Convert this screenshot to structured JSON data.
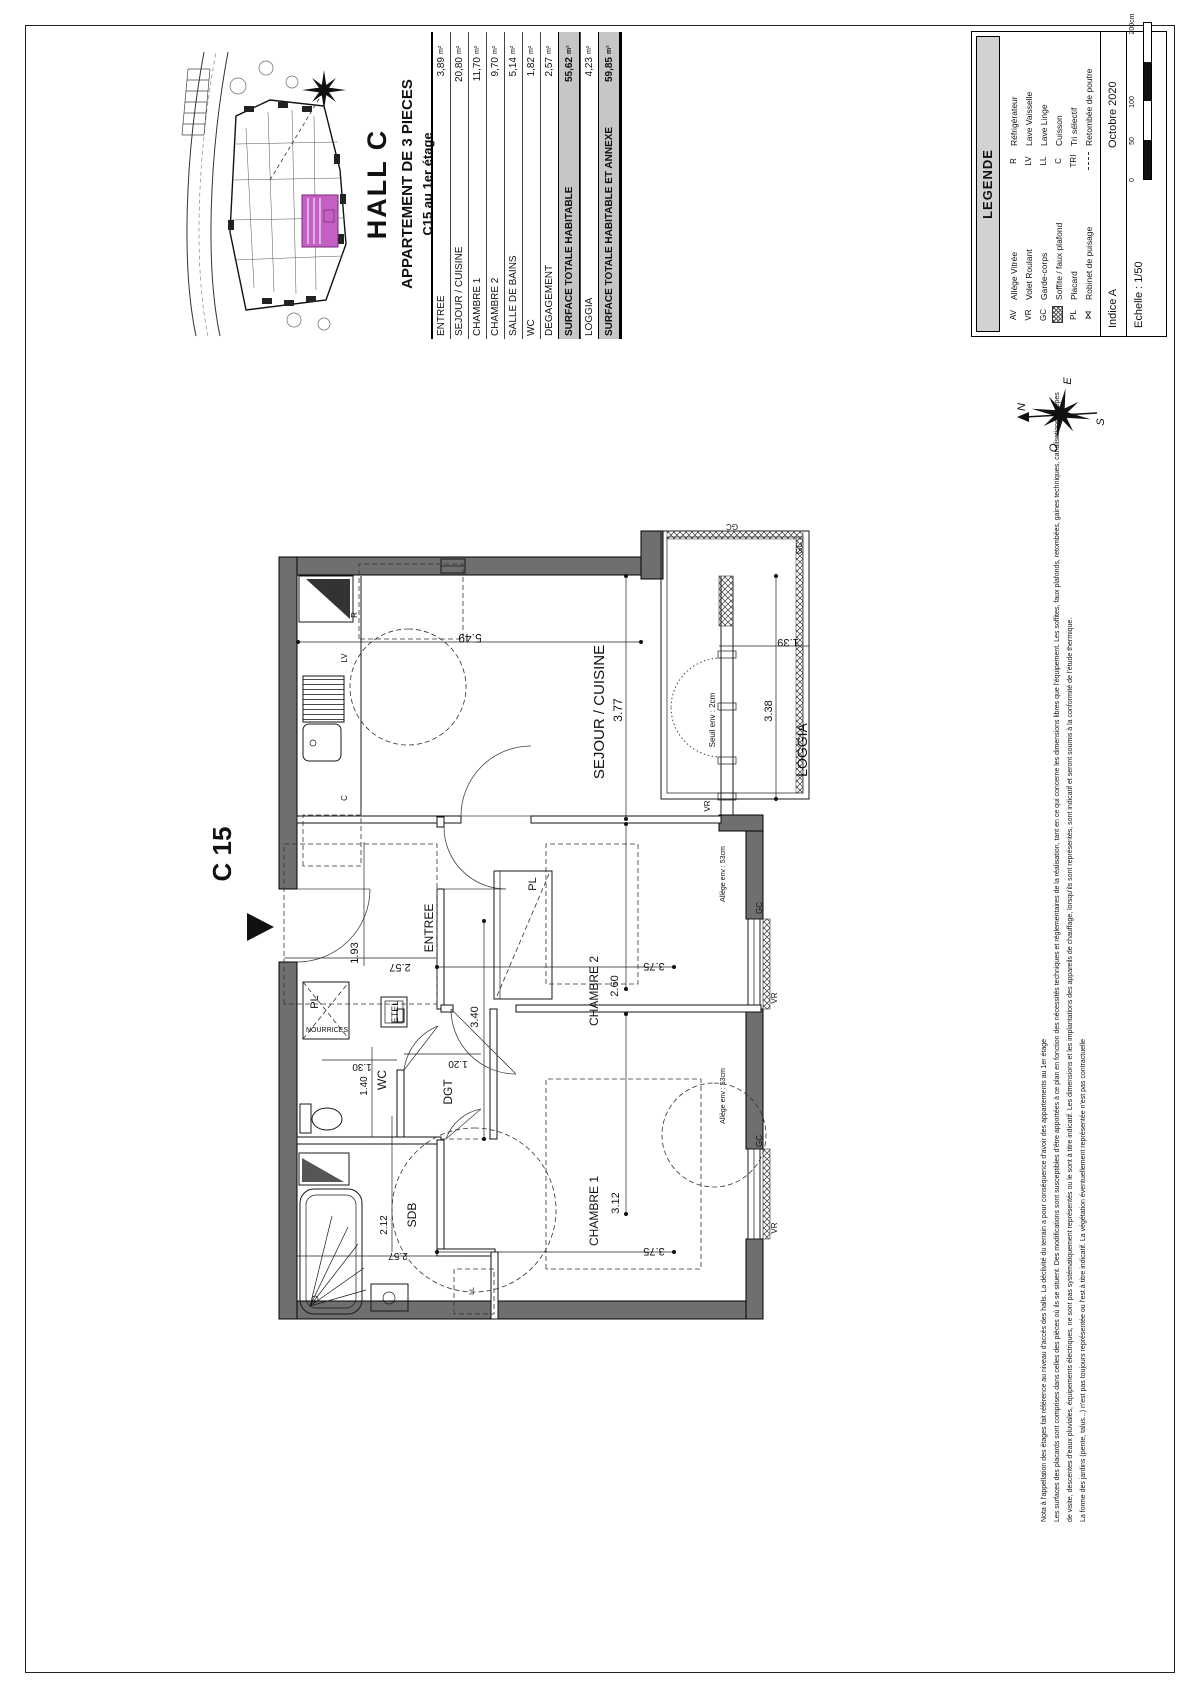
{
  "sheet": {
    "hall": "HALL C",
    "apartment_type": "APPARTEMENT DE 3 PIECES",
    "apartment_floor": "C15 au 1er étage",
    "unit_label": "C 15"
  },
  "areas_table": {
    "rows": [
      {
        "label": "ENTREE",
        "value": "3,89",
        "unit": "m²",
        "highlight": false
      },
      {
        "label": "SEJOUR / CUISINE",
        "value": "20,80",
        "unit": "m²",
        "highlight": false
      },
      {
        "label": "CHAMBRE 1",
        "value": "11,70",
        "unit": "m²",
        "highlight": false
      },
      {
        "label": "CHAMBRE 2",
        "value": "9,70",
        "unit": "m²",
        "highlight": false
      },
      {
        "label": "SALLE DE BAINS",
        "value": "5,14",
        "unit": "m²",
        "highlight": false
      },
      {
        "label": "WC",
        "value": "1,82",
        "unit": "m²",
        "highlight": false
      },
      {
        "label": "DEGAGEMENT",
        "value": "2,57",
        "unit": "m²",
        "highlight": false
      },
      {
        "label": "SURFACE TOTALE HABITABLE",
        "value": "55,62",
        "unit": "m²",
        "highlight": true
      },
      {
        "label": "LOGGIA",
        "value": "4,23",
        "unit": "m²",
        "highlight": false
      },
      {
        "label": "SURFACE TOTALE HABITABLE ET ANNEXE",
        "value": "59,85",
        "unit": "m²",
        "highlight": true
      }
    ]
  },
  "legend": {
    "title": "LEGENDE",
    "left": [
      {
        "abbr": "AV",
        "label": "Allège Vitrée",
        "icon": ""
      },
      {
        "abbr": "VR",
        "label": "Volet Roulant",
        "icon": ""
      },
      {
        "abbr": "GC",
        "label": "Garde-corps",
        "icon": ""
      },
      {
        "abbr": "",
        "label": "Soffite / faux plafond",
        "icon": "hatch"
      },
      {
        "abbr": "PL",
        "label": "Placard",
        "icon": ""
      },
      {
        "abbr": "",
        "label": "Robinet de puisage",
        "icon": "tap"
      }
    ],
    "right": [
      {
        "abbr": "R",
        "label": "Réfrigérateur",
        "icon": ""
      },
      {
        "abbr": "LV",
        "label": "Lave Vaisselle",
        "icon": ""
      },
      {
        "abbr": "LL",
        "label": "Lave Linge",
        "icon": ""
      },
      {
        "abbr": "C",
        "label": "Cuisson",
        "icon": ""
      },
      {
        "abbr": "TRI",
        "label": "Tri sélectif",
        "icon": ""
      },
      {
        "abbr": "",
        "label": "Retombée de poutre",
        "icon": "dash"
      }
    ]
  },
  "meta": {
    "indice": "Indice A",
    "date": "Octobre 2020",
    "scale": "Echelle :  1/50",
    "scale_ticks": [
      {
        "label": "0",
        "pos": 0
      },
      {
        "label": "50",
        "pos": 0.25
      },
      {
        "label": "100",
        "pos": 0.5
      },
      {
        "label": "200cm",
        "pos": 1
      }
    ]
  },
  "compass": {
    "n": "N",
    "e": "E",
    "s": "S",
    "o": "O"
  },
  "notes": {
    "lines": [
      "Nota à l'appellation des étages fait référence au niveau d'accès des halls. La déclivité du terrain a pour conséquence d'avoir des appartements au 1er étage",
      "Les surfaces des placards sont comprises dans celles des pièces où ils se situent. Des modifications sont susceptibles d'être apportées à ce plan en fonction des nécessités techniques et réglementaires de la réalisation, tant en ce qui concerne les dimensions libres que l'équipement. Les soffites, faux plafonds, retombées, gaines techniques, canalisations, trappes",
      "de visite, descentes d'eaux pluviales, équipements électriques, ne sont pas systématiquement représentés ou le sont à titre indicatif. Les dimensions et les implantations des appareils de chauffage, lorsqu'ils sont représentés, sont indicatif et seront soumis à la conformité de l'étude thermique.",
      "La forme des jardins (pente, talus...) n'est pas toujours représentée ou l'est à titre indicatif. La végétation éventuellement représentée n'est pas contractuelle"
    ]
  },
  "plan_labels": [
    {
      "t": "C 15",
      "x": 818,
      "y": 205,
      "s": 26,
      "b": true
    },
    {
      "t": "SEJOUR / CUISINE",
      "x": 960,
      "y": 578,
      "s": 15
    },
    {
      "t": "3.77",
      "x": 962,
      "y": 596,
      "s": 12
    },
    {
      "t": "5.49",
      "x": 1038,
      "y": 444,
      "s": 12,
      "r": -90
    },
    {
      "t": "LOGGIA",
      "x": 922,
      "y": 781,
      "s": 14
    },
    {
      "t": "3.38",
      "x": 961,
      "y": 746,
      "s": 11
    },
    {
      "t": "1.39",
      "x": 1033,
      "y": 762,
      "s": 11,
      "r": -90
    },
    {
      "t": "Seuil env : 2cm",
      "x": 952,
      "y": 689,
      "s": 8
    },
    {
      "t": "VR",
      "x": 866,
      "y": 684,
      "s": 8
    },
    {
      "t": "GC",
      "x": 1124,
      "y": 776,
      "s": 8
    },
    {
      "t": "GC",
      "x": 1148,
      "y": 706,
      "s": 8,
      "r": -90
    },
    {
      "t": "ENTREE",
      "x": 744,
      "y": 407,
      "s": 12
    },
    {
      "t": "1.93",
      "x": 719,
      "y": 332,
      "s": 11
    },
    {
      "t": "2.57",
      "x": 708,
      "y": 374,
      "s": 11,
      "r": -90
    },
    {
      "t": "3.40",
      "x": 655,
      "y": 452,
      "s": 11
    },
    {
      "t": "PL",
      "x": 670,
      "y": 292,
      "s": 11
    },
    {
      "t": "NOURRICES",
      "x": 640,
      "y": 280,
      "s": 7,
      "r": 90,
      "a": "start"
    },
    {
      "t": "ETEL",
      "x": 660,
      "y": 372,
      "s": 9
    },
    {
      "t": "WC",
      "x": 592,
      "y": 360,
      "s": 12
    },
    {
      "t": "1.30",
      "x": 608,
      "y": 336,
      "s": 10,
      "r": -90
    },
    {
      "t": "1.40",
      "x": 586,
      "y": 341,
      "s": 10
    },
    {
      "t": "DGT",
      "x": 580,
      "y": 426,
      "s": 12
    },
    {
      "t": "1.20",
      "x": 611,
      "y": 432,
      "s": 10,
      "r": -90
    },
    {
      "t": "SDB",
      "x": 457,
      "y": 390,
      "s": 12
    },
    {
      "t": "2.12",
      "x": 447,
      "y": 361,
      "s": 10
    },
    {
      "t": "2.57",
      "x": 419,
      "y": 372,
      "s": 10,
      "r": -90
    },
    {
      "t": "LL",
      "x": 381,
      "y": 448,
      "s": 7
    },
    {
      "t": "CHAMBRE 2",
      "x": 681,
      "y": 572,
      "s": 12
    },
    {
      "t": "2.60",
      "x": 686,
      "y": 592,
      "s": 11
    },
    {
      "t": "3.75",
      "x": 709,
      "y": 628,
      "s": 11,
      "r": -90
    },
    {
      "t": "PL",
      "x": 788,
      "y": 510,
      "s": 11
    },
    {
      "t": "CHAMBRE 1",
      "x": 461,
      "y": 572,
      "s": 12
    },
    {
      "t": "3.12",
      "x": 469,
      "y": 593,
      "s": 11
    },
    {
      "t": "3.75",
      "x": 424,
      "y": 628,
      "s": 11,
      "r": -90
    },
    {
      "t": "Allège env : 53cm",
      "x": 798,
      "y": 699,
      "s": 7
    },
    {
      "t": "Allège env : 53cm",
      "x": 576,
      "y": 699,
      "s": 7
    },
    {
      "t": "VR",
      "x": 674,
      "y": 751,
      "s": 8
    },
    {
      "t": "VR",
      "x": 444,
      "y": 751,
      "s": 8
    },
    {
      "t": "GC",
      "x": 764,
      "y": 736,
      "s": 8
    },
    {
      "t": "GC",
      "x": 531,
      "y": 736,
      "s": 8
    },
    {
      "t": "R",
      "x": 1057,
      "y": 331,
      "s": 8
    },
    {
      "t": "LV",
      "x": 1014,
      "y": 321,
      "s": 8
    },
    {
      "t": "C",
      "x": 874,
      "y": 321,
      "s": 8
    }
  ],
  "colors": {
    "accent": "#c45fc4",
    "accent_dark": "#7a2a7a",
    "wall": "#6f6f6f",
    "row_highlight": "#c6c6c6",
    "legend_bar": "#d2d2d2"
  }
}
